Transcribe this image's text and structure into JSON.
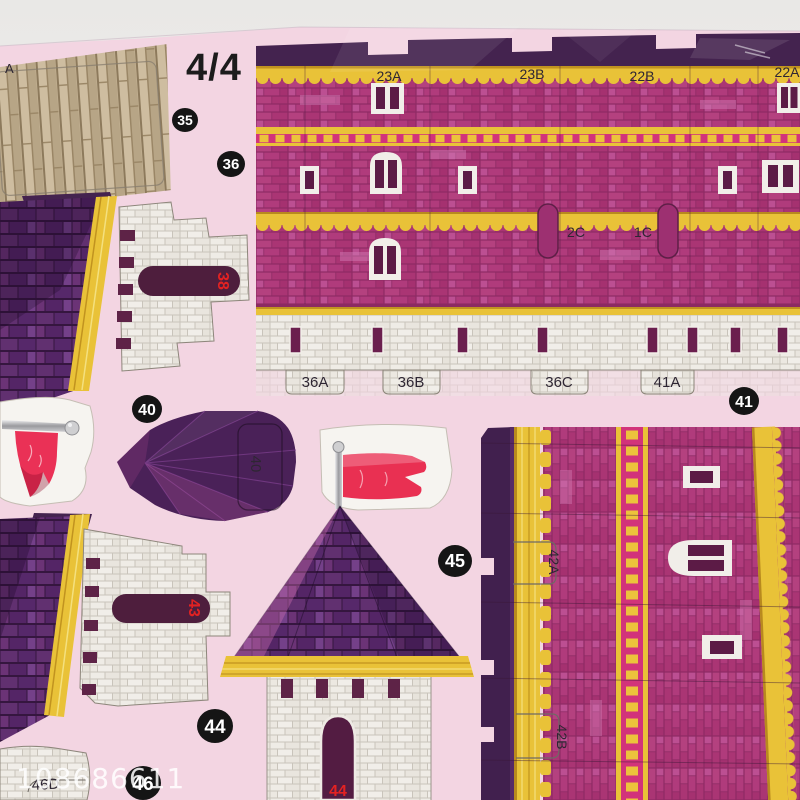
{
  "page": {
    "indicator": "4/4",
    "partial_edge_label": "A",
    "watermark": "108686611"
  },
  "badges": {
    "b35": "35",
    "b36": "36",
    "b40": "40",
    "b41": "41",
    "b44": "44",
    "b45": "45",
    "b46": "46"
  },
  "wall": {
    "panel_labels": [
      "23A",
      "23B",
      "22B",
      "22A"
    ],
    "slot_labels": [
      "2C",
      "1C"
    ],
    "tab_labels": [
      "36A",
      "36B",
      "36C",
      "41A"
    ]
  },
  "pieces": {
    "roof_slot_38": "38",
    "roof_slot_43": "43",
    "tower_door_44": "44",
    "cone_40": "40",
    "tower42_tab_a": "42A",
    "tower42_tab_b": "42B",
    "brick_46d": "46D"
  },
  "colors": {
    "sheet_pink": "#f3d5e2",
    "brick_magenta": "#b13c82",
    "dark_purple": "#44234f",
    "trim_yellow": "#e9c238",
    "crimson_band": "#d2337a",
    "stone_white": "#efece6",
    "flag_red": "#ea3156",
    "badge_black": "#151515",
    "red_label": "#e32222"
  }
}
